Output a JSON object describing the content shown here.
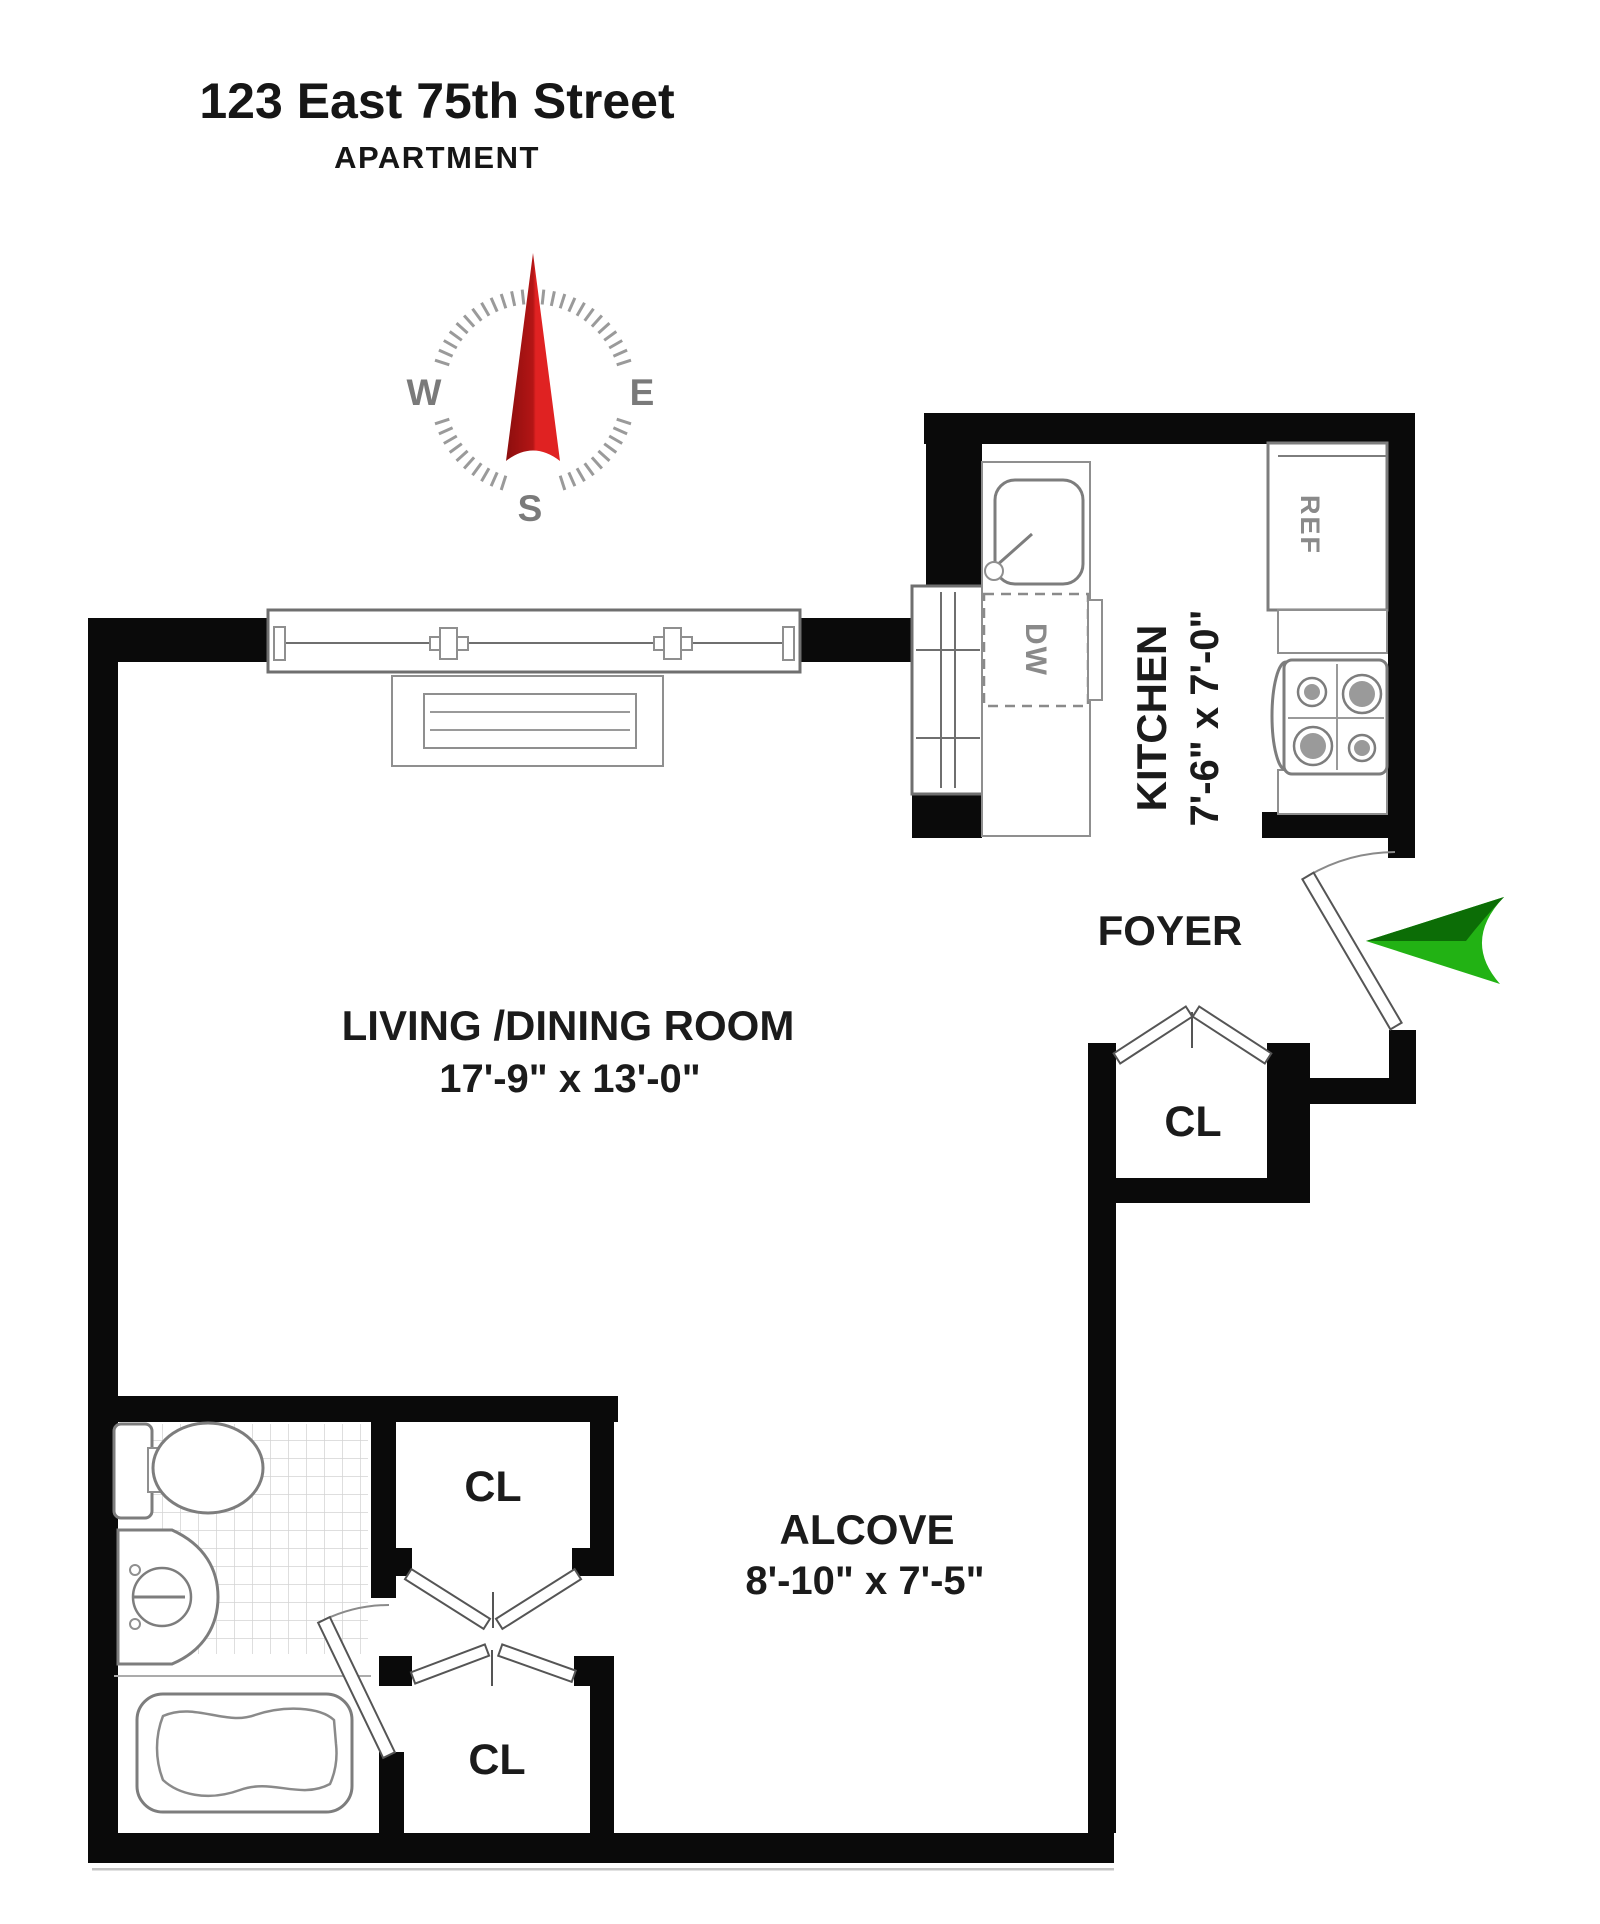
{
  "header": {
    "title": "123 East 75th Street",
    "subtitle": "APARTMENT"
  },
  "compass": {
    "west": "W",
    "east": "E",
    "south": "S"
  },
  "rooms": {
    "living": {
      "name": "LIVING /DINING ROOM",
      "dims": "17'-9\" x 13'-0\""
    },
    "kitchen": {
      "name": "KITCHEN",
      "dims": "7'-6\" x 7'-0\""
    },
    "foyer": {
      "name": "FOYER"
    },
    "alcove": {
      "name": "ALCOVE",
      "dims": "8'-10\" x 7'-5\""
    }
  },
  "closets": {
    "foyer_closet": "CL",
    "alcove_closet_upper": "CL",
    "alcove_closet_lower": "CL"
  },
  "appliances": {
    "refrigerator": "REF",
    "dishwasher": "DW"
  },
  "icons": {
    "compass_needle": "north-needle-icon",
    "entry_arrow": "entry-direction-arrow-icon"
  },
  "colors": {
    "wall": "#0a0a0a",
    "needle_dark": "#8c0e0e",
    "needle_mid": "#b31515",
    "needle_bright": "#e02222",
    "arrow_green": "#22b214",
    "arrow_green_dark": "#0c6d06",
    "label_text": "#1b1b1b",
    "muted_text": "#8a8a8a"
  }
}
